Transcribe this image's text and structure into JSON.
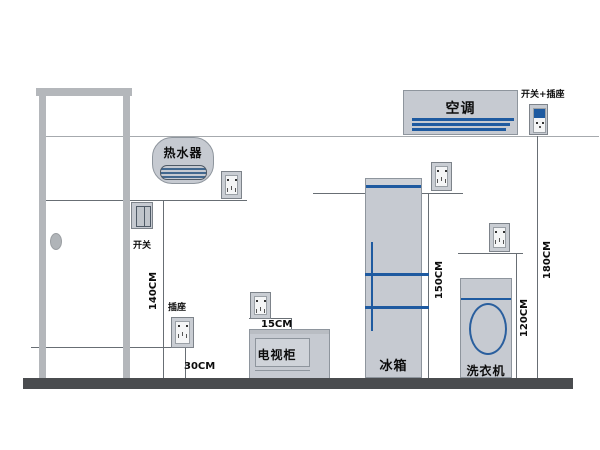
{
  "appliances": {
    "water_heater": "热水器",
    "air_conditioner": "空调",
    "fridge": "冰箱",
    "washing_machine": "洗衣机",
    "tv_cabinet": "电视柜"
  },
  "electrical": {
    "switch_label": "开关",
    "socket_label": "插座",
    "switch_plus_socket_label": "开关+插座"
  },
  "dimensions": {
    "switch_height": "140CM",
    "low_socket_height": "30CM",
    "tv_socket_offset": "15CM",
    "fridge_socket_height": "150CM",
    "washer_socket_height": "120CM",
    "ac_socket_height": "180CM"
  },
  "colors": {
    "accent_blue": "#1e5aa0",
    "appliance_fill": "#c6cad1",
    "floor_gray": "#4a4c4f",
    "door_frame_gray": "#b4b7bb"
  }
}
